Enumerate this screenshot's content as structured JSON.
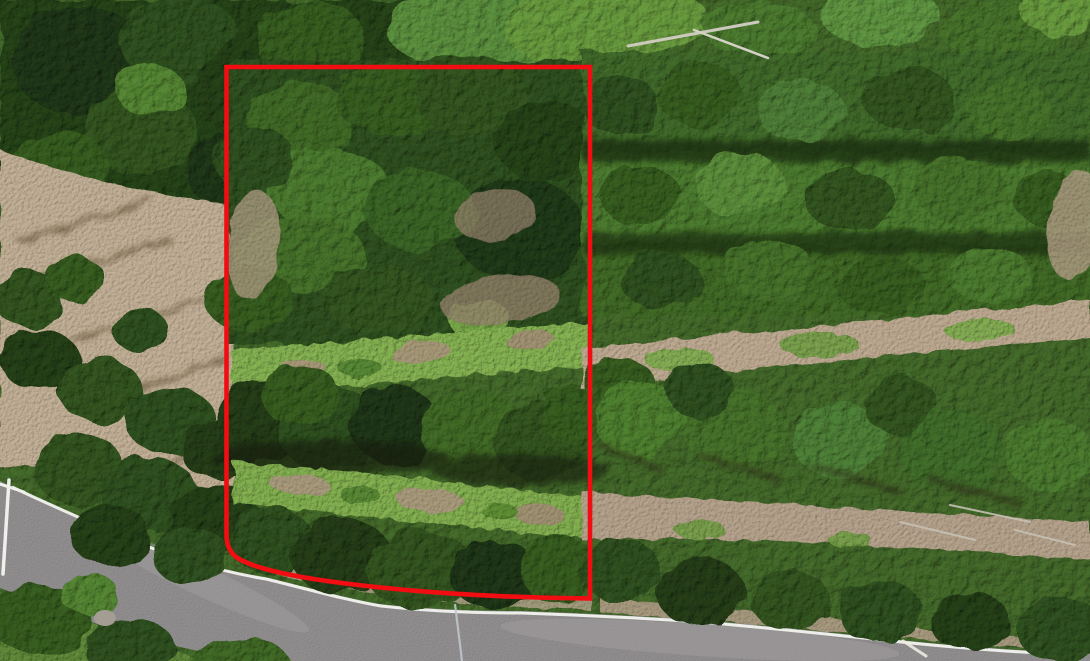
{
  "scene": {
    "type": "aerial-drone-photo",
    "description": "Overhead drone photograph of a wooded rural land parcel outlined with a red boundary annotation. A curving paved road with a white edge stripe crosses the lower-left corner, a bare soil clearing with long tree shadows lies on the left, and rows of planted conifers with dirt strips and silver fallen logs fill the right half."
  },
  "overlay": {
    "boundary_color": "#f20d12",
    "boundary_stroke_px": 4.6,
    "shape": "rectangular parcel outline, square top corners, lower edge curving along the road with a rounded lower-left corner"
  },
  "palette": {
    "canopy_base": "#3c6026",
    "canopy_dark": "#243d17",
    "canopy_mid": "#3f6828",
    "canopy_bright": "#5e8c37",
    "brush_light": "#7aa44c",
    "soil": "#b7a68e",
    "soil_dark": "#a5947c",
    "road_asphalt": "#918e8f",
    "road_stripe": "#f2f3ef",
    "guardrail_white": "#eef0ec",
    "utility_line": "#bdc6ca",
    "log_silver": "#ccc9bd",
    "shadow_dark": "#141f0d"
  }
}
